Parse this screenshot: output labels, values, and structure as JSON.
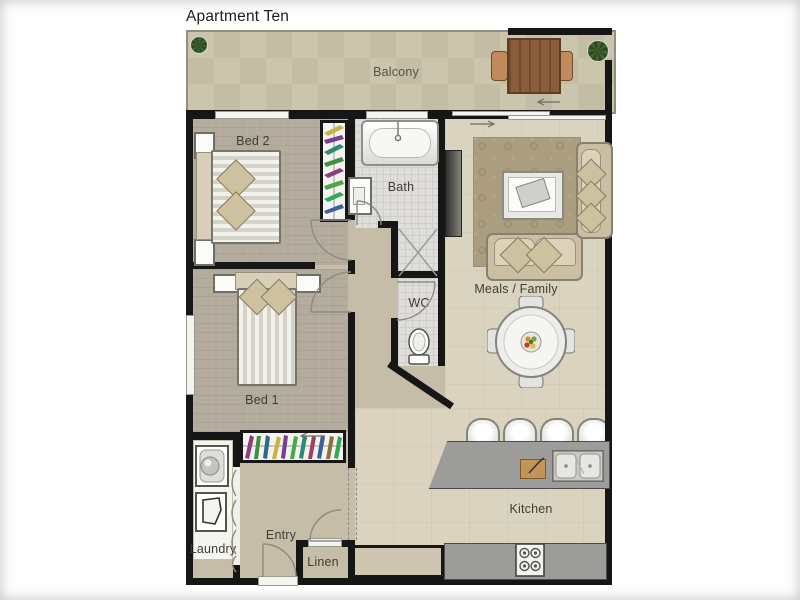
{
  "title": "Apartment Ten",
  "labels": {
    "balcony": "Balcony",
    "bed2": "Bed 2",
    "bath": "Bath",
    "wc": "WC",
    "meals_family": "Meals / Family",
    "bed1": "Bed 1",
    "laundry": "Laundry",
    "entry": "Entry",
    "linen": "Linen",
    "kitchen": "Kitchen"
  },
  "palette": {
    "wall": "#161616",
    "balcony_floor": "#c7c1aa",
    "bedroom_floor": "#b3ab9c",
    "living_floor": "#dad3bf",
    "hall_floor": "#c6bda9",
    "tile_floor": "#dedddb",
    "granite": "#9c9c9a",
    "wood": "#8a5d3b",
    "fabric": "#d5caae",
    "rug": "#ab9e80"
  },
  "furniture": {
    "balcony": [
      "potted-plant",
      "outdoor-table",
      "outdoor-chair",
      "outdoor-chair",
      "potted-plant"
    ],
    "bed2": [
      "double-bed",
      "nightstand",
      "nightstand",
      "wardrobe"
    ],
    "bath": [
      "bathtub",
      "vanity-basin",
      "shower"
    ],
    "wc": [
      "toilet"
    ],
    "meals_family": [
      "tv",
      "rug",
      "coffee-table",
      "sofa",
      "chaise",
      "dining-table",
      "dining-chairs",
      "fruit-bowl"
    ],
    "bed1": [
      "double-bed",
      "nightstand",
      "nightstand",
      "wardrobe"
    ],
    "laundry": [
      "washing-machine",
      "laundry-tub"
    ],
    "kitchen": [
      "island-bench",
      "bar-stool",
      "bar-stool",
      "bar-stool",
      "bar-stool",
      "double-sink",
      "cutting-board",
      "cooktop",
      "cabinet-bench"
    ]
  }
}
